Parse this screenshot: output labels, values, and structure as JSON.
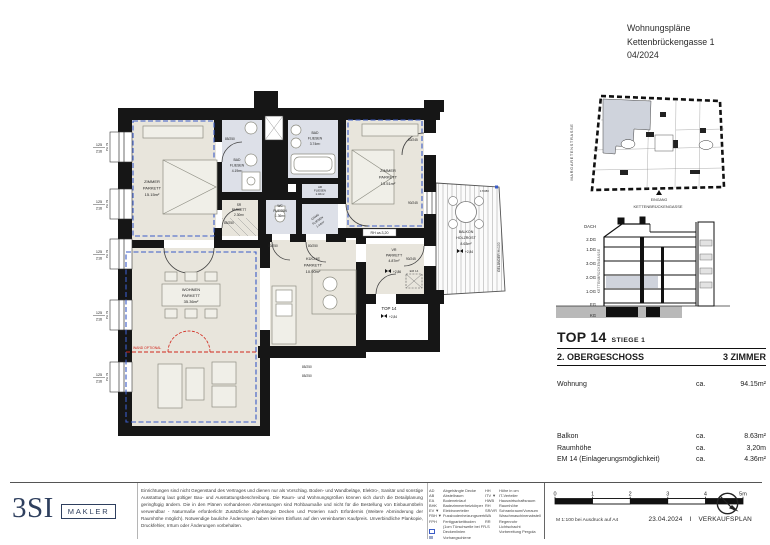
{
  "header": {
    "line1": "Wohnungspläne",
    "line2": "Kettenbrückengasse 1",
    "line3": "04/2024"
  },
  "plan": {
    "rooms": {
      "zimmer1": {
        "name": "ZIMMER",
        "finish": "PARKETT",
        "area": "15.15m²"
      },
      "bad1": {
        "name": "BAD",
        "finish": "FLIESEN",
        "area": "4.19m²"
      },
      "sr": {
        "name": "SR",
        "finish": "PARKETT",
        "area": "2.30m²"
      },
      "wc": {
        "name": "WC",
        "finish": "FLIESEN",
        "area": "1.36m²"
      },
      "bad2": {
        "name": "BAD",
        "finish": "FLIESEN",
        "area": "3.74m²"
      },
      "ar": {
        "name": "AR",
        "finish": "FLIESEN",
        "area": "1.46m²"
      },
      "gang": {
        "name": "GANG",
        "finish": "FLIESEN",
        "area": "1.44m²"
      },
      "zimmer2": {
        "name": "ZIMMER",
        "finish": "PARKETT",
        "area": "13.51m²"
      },
      "kueche": {
        "name": "KÜCHE",
        "finish": "PARKETT",
        "area": "10.90m²"
      },
      "wohnen": {
        "name": "WOHNEN",
        "finish": "PARKETT",
        "area": "35.36m²"
      },
      "vr": {
        "name": "VR",
        "finish": "PARKETT",
        "area": "4.87m²"
      },
      "balkon": {
        "name": "BALKON",
        "finish": "HOLZROST",
        "area": "8.63m²"
      }
    },
    "labels": {
      "window_w": "125",
      "window_h": "216",
      "parapet": "PH 79",
      "door_85_250": "85/250",
      "door_80_250": "80/250",
      "door_80_245": "80/245",
      "door_90_245": "90/245",
      "balcony_dim": "170/80",
      "rh": "RH ca.3,20",
      "gelaender": "GELÄNDER H=100",
      "top_unit": "TOP 14",
      "em": "EM 14",
      "wall_optional": "WAND OPTIONAL",
      "level_vr": "+2,86",
      "level_entry": "+2,84",
      "level_balcony": "+2,84"
    }
  },
  "siteplan": {
    "street_left": "MARGARETENSTRASSE",
    "entrance_line1": "EINGANG",
    "entrance_line2": "KETTENBRÜCKENGASSE"
  },
  "section": {
    "floors": [
      "DACH",
      "2.DG",
      "1.DG",
      "3.OG",
      "2.OG",
      "1.OG",
      "EG",
      "KG"
    ],
    "street": "KETTENBRÜCKENGASSE"
  },
  "info": {
    "top": "TOP 14",
    "stiege": "STIEGE 1",
    "floor": "2. OBERGESCHOSS",
    "rooms": "3 ZIMMER",
    "row_wohnung": {
      "label": "Wohnung",
      "ca": "ca.",
      "value": "94.15m²"
    },
    "row_balkon": {
      "label": "Balkon",
      "ca": "ca.",
      "value": "8.63m²"
    },
    "row_raumhoehe": {
      "label": "Raumhöhe",
      "ca": "ca.",
      "value": "3,20m"
    },
    "row_em": {
      "label": "EM 14 (Einlagerungsmöglichkeit)",
      "ca": "ca.",
      "value": "4.36m²"
    }
  },
  "footer": {
    "logo_main": "3SI",
    "logo_sub": "MAKLER",
    "disclaimer": "Einrichtungen sind nicht Gegenstand des Vertrages und dienen nur als Vorschlag. Boden- und Wandbeläge, Elektro-, Sanitär und sonstige Ausstattung laut gültiger Bau- und Ausstattungsbeschreibung. Die Raum- und Wohnungsgrößen können sich durch die Detailplanung geringfügig ändern. Die in den Plänen vorhandenen Abmessungen sind Rohbaumaße und nicht für die Bestellung von Einbaumöbeln verwendbar - Naturmaße erforderlich! Zusätzliche abgehängte Decken und Poterien nach Erfordernis (Weitere Abminderung der Raumhöhe möglich). Notwendige bauliche Änderungen haben keinen Einfluss auf den vereinbarten Kaufpreis. Unverbindliche Plankopie, Druckfehler, Irrtum oder Änderungen vorbehalten.",
    "legend_left": [
      {
        "a": "AD",
        "d": "Abgehängte Decke"
      },
      {
        "a": "AB",
        "d": "Abstellraum"
      },
      {
        "a": "EA",
        "d": "Bodeneinlauf"
      },
      {
        "a": "BHK",
        "d": "Badezimmerheizkörper"
      },
      {
        "a": "EV ▼",
        "d": "Elektroverteiler"
      },
      {
        "a": "FBH ▼",
        "d": "Fussbodenheizungsverteiler"
      },
      {
        "a": "FPH",
        "d": "Fertigparkettboden"
      },
      {
        "a": "",
        "d": "(1cm Türschwelle bei FPH 0)"
      },
      {
        "a": "",
        "d": "Deckenlinien"
      },
      {
        "a": "",
        "d": "Vorhangschiene"
      }
    ],
    "legend_right": [
      {
        "a": "HH",
        "d": "Höhe in cm"
      },
      {
        "a": "ITV ▼",
        "d": "IT-Verteiler"
      },
      {
        "a": "HWB",
        "d": "Hauswirtschaftsraum"
      },
      {
        "a": "RH",
        "d": "Raumhöhe"
      },
      {
        "a": "SR/VR",
        "d": "Schrankraum/Vorraum"
      },
      {
        "a": "WA",
        "d": "Waschmaschinenabstellplatz"
      },
      {
        "a": "RR",
        "d": "Regenrohr"
      },
      {
        "a": "LS",
        "d": "Lichtschacht"
      },
      {
        "a": "",
        "d": "Vorbereitung Pergola"
      }
    ],
    "scale_ticks": [
      "0",
      "1",
      "2",
      "3",
      "4",
      "5m"
    ],
    "scale_note": "M 1:100 bei Ausdruck auf A4",
    "date": "23.04.2024",
    "separator": "I",
    "plan_type": "VERKAUFSPLAN"
  },
  "colors": {
    "accent_blue": "#3a5bc7",
    "optional_red": "#d1261b",
    "brand_navy": "#2e3f5e",
    "room_parquet": "#e8e5dc",
    "room_tile": "#dde0e8",
    "highlight_unit": "#cfd3dc",
    "wall": "#161616"
  }
}
